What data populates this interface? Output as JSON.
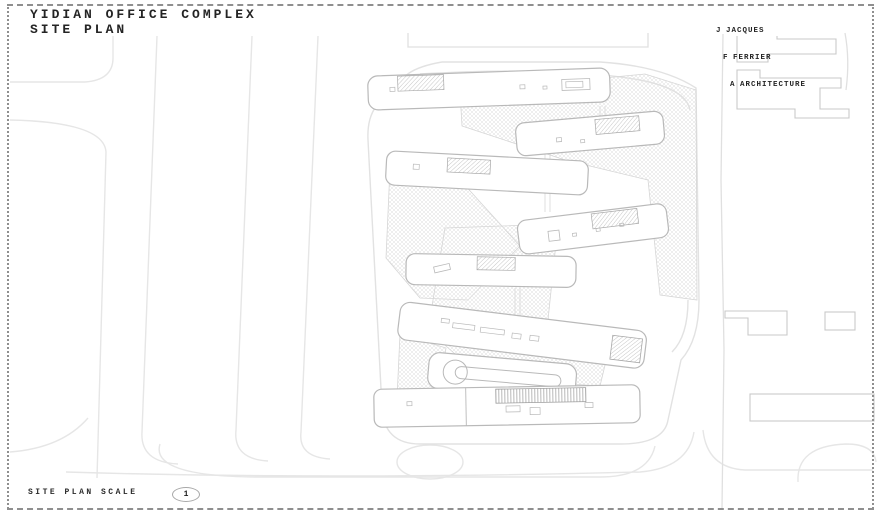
{
  "title_block": {
    "line1": "YIDIAN OFFICE COMPLEX",
    "line2": "SITE PLAN"
  },
  "architect_block": {
    "lines": [
      {
        "initial": "J",
        "word": "JACQUES"
      },
      {
        "initial": "F",
        "word": "FERRIER"
      },
      {
        "initial": "A",
        "word": "ARCHITECTURE"
      }
    ]
  },
  "scale_block": {
    "label": "SITE PLAN SCALE",
    "bubble_number": "1"
  },
  "drawing": {
    "type": "architectural-site-plan",
    "colors": {
      "sheet_background": "#ffffff",
      "border": "#8f8f8f",
      "road_line": "#e3e3e3",
      "building_stroke": "#b9b9b9",
      "landscape_hatch": "#dadada",
      "roof_hatch": "#b0b0b0",
      "text": "#242424"
    },
    "elements": {
      "office_bar_buildings": 8,
      "context_buildings": 6,
      "highway_lanes_left": 4,
      "landscape_zigzag_hatched": true
    }
  }
}
